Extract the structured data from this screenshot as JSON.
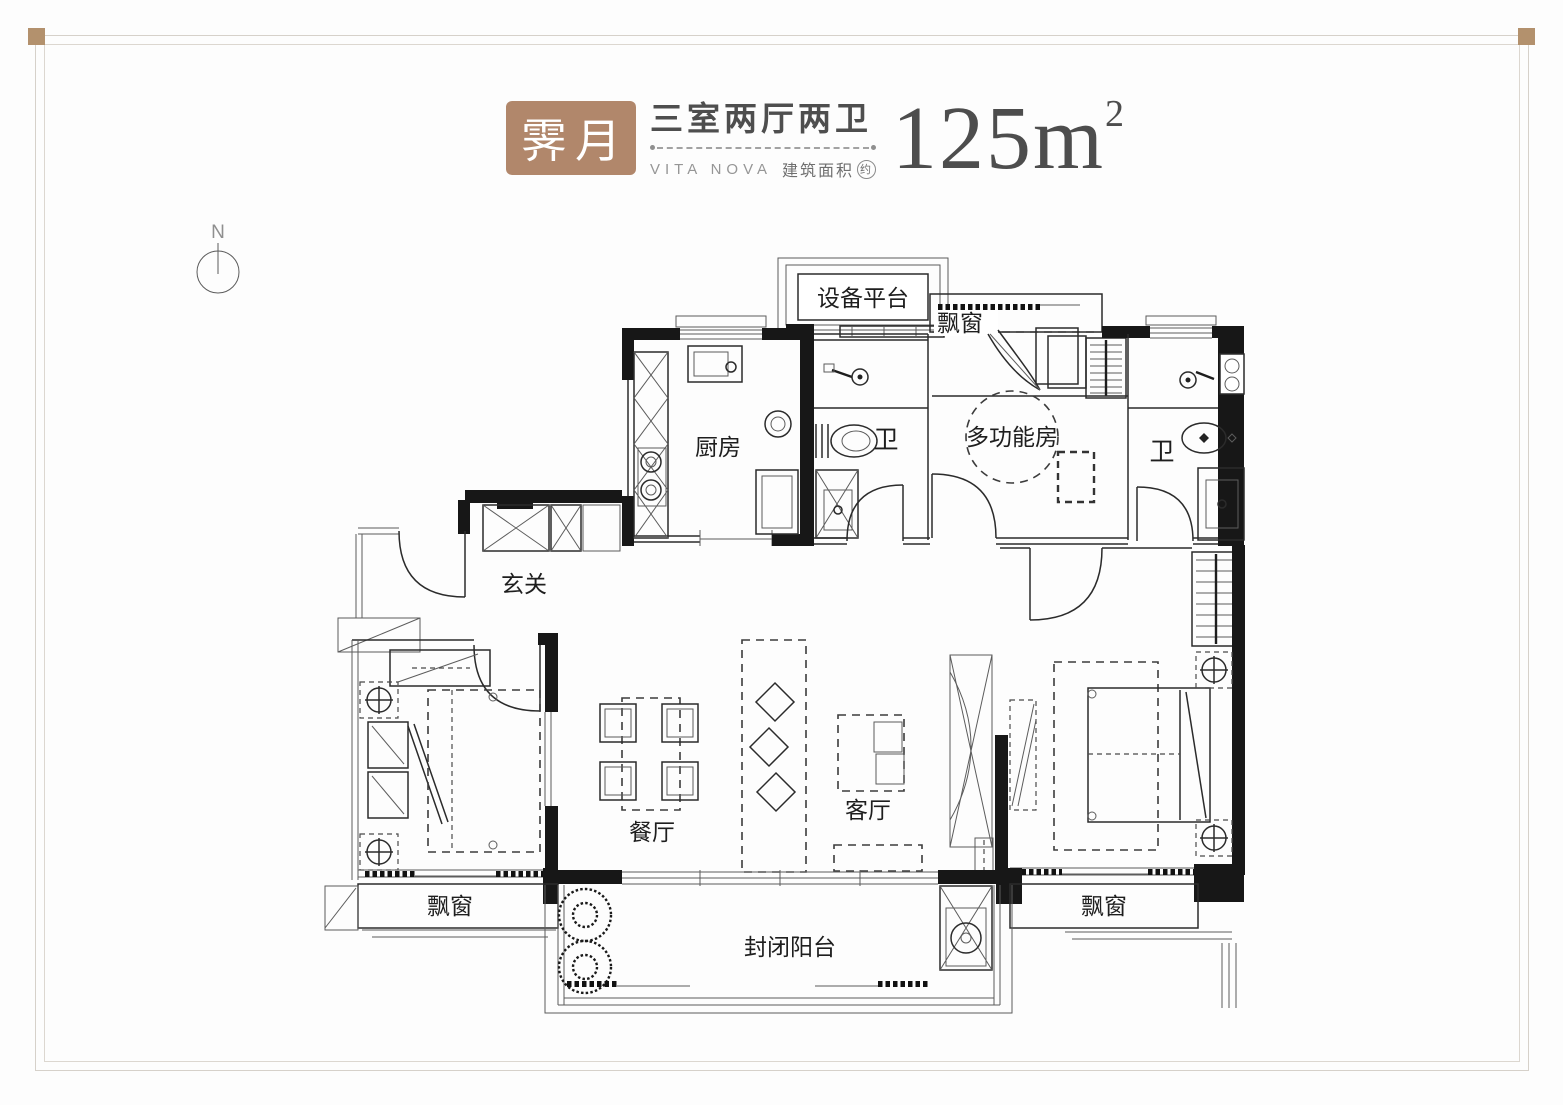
{
  "header": {
    "brand": "霁月",
    "brand_en": "VITA NOVA",
    "layout": "三室两厅两卫",
    "area_label": "建筑面积",
    "area_label_circle": "约",
    "area_value_unit": "125m",
    "area_sup": "2",
    "brand_bg": "#b1876b"
  },
  "compass": {
    "label": "N"
  },
  "rooms": {
    "equipment_platform": "设备平台",
    "bay_window_top": "飘窗",
    "kitchen": "厨房",
    "bath1": "卫",
    "multi_room": "多功能房",
    "bath2": "卫",
    "foyer": "玄关",
    "dining": "餐厅",
    "living": "客厅",
    "bay_window_left": "飘窗",
    "bay_window_right": "飘窗",
    "balcony": "封闭阳台"
  },
  "colors": {
    "accent": "#b1876b",
    "frame": "#d6d1ca",
    "wall": "#171717"
  }
}
